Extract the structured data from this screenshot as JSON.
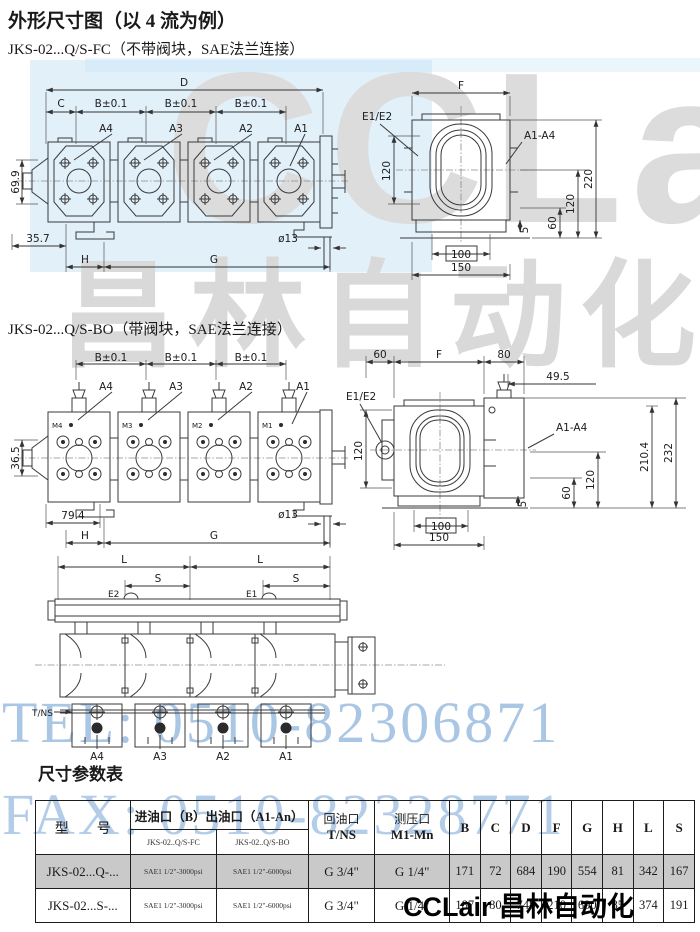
{
  "page": {
    "title": "外形尺寸图（以 4 流为例）",
    "section1_subtitle": "JKS-02...Q/S-FC（不带阀块，SAE法兰连接）",
    "section2_subtitle": "JKS-02...Q/S-BO（带阀块，SAE法兰连接）",
    "table_title": "尺寸参数表"
  },
  "watermarks": {
    "cclair_text": "CCLair",
    "chinese_text": "昌林自动化",
    "tel": "TEL: 0510-82306871",
    "fax": "FAX: 0510-82328771",
    "footer": "CCLair 昌林自动化"
  },
  "colors": {
    "blue_box": "#c6e2f6",
    "watermark_gray": "#dcdcdc",
    "watermark_blue_text": "#a9c6e4",
    "row_shade": "#c9c9c9"
  },
  "d1l": {
    "D": "D",
    "C": "C",
    "B": "B±0.1",
    "A4": "A4",
    "A3": "A3",
    "A2": "A2",
    "A1": "A1",
    "h699": "69.9",
    "h357": "35.7",
    "H": "H",
    "G": "G",
    "dia": "ø13"
  },
  "d1r": {
    "F": "F",
    "E": "E1/E2",
    "v120": "120",
    "A": "A1-A4",
    "v220": "220",
    "v120b": "120",
    "v60": "60",
    "b100": "100",
    "b150": "150",
    "b5": "5"
  },
  "d2l": {
    "B": "B±0.1",
    "A4": "A4",
    "A3": "A3",
    "A2": "A2",
    "A1": "A1",
    "M4": "M4",
    "M3": "M3",
    "M2": "M2",
    "M1": "M1",
    "h365": "36.5",
    "h794": "79.4",
    "H": "H",
    "G": "G",
    "dia": "ø13"
  },
  "d2r": {
    "t60": "60",
    "F": "F",
    "t80": "80",
    "t495": "49.5",
    "E": "E1/E2",
    "v120": "120",
    "A": "A1-A4",
    "v2104": "210.4",
    "v232": "232",
    "v120b": "120",
    "v60": "60",
    "b100": "100",
    "b150": "150",
    "b5": "5"
  },
  "d3": {
    "L": "L",
    "S": "S",
    "E2": "E2",
    "E1": "E1",
    "TNS": "T/NS",
    "A4": "A4",
    "A3": "A3",
    "A2": "A2",
    "A1": "A1"
  },
  "table": {
    "header": {
      "model": "型　　号",
      "inlet_group": "进油口（B）出油口（A1-An）",
      "sub_fc": "JKS-02..Q/S-FC",
      "sub_bo": "JKS-02..Q/S-BO",
      "return_port": "回油口",
      "return_sub": "T/NS",
      "gauge_port": "测压口",
      "gauge_sub": "M1-Mn",
      "letters": [
        "B",
        "C",
        "D",
        "F",
        "G",
        "H",
        "L",
        "S"
      ]
    },
    "rows": [
      {
        "model": "JKS-02...Q-...",
        "fc": "SAE1 1/2\"-3000psi",
        "bo": "SAE1 1/2\"-6000psi",
        "t": "G 3/4\"",
        "m": "G 1/4\"",
        "values": [
          "171",
          "72",
          "684",
          "190",
          "554",
          "81",
          "342",
          "167"
        ]
      },
      {
        "model": "JKS-02...S-...",
        "fc": "SAE1 1/2\"-3000psi",
        "bo": "SAE1 1/2\"-6000psi",
        "t": "G 3/4\"",
        "m": "G 1/4\"",
        "values": [
          "187",
          "80",
          "748",
          "210",
          "690",
          "85",
          "374",
          "191"
        ]
      }
    ]
  }
}
